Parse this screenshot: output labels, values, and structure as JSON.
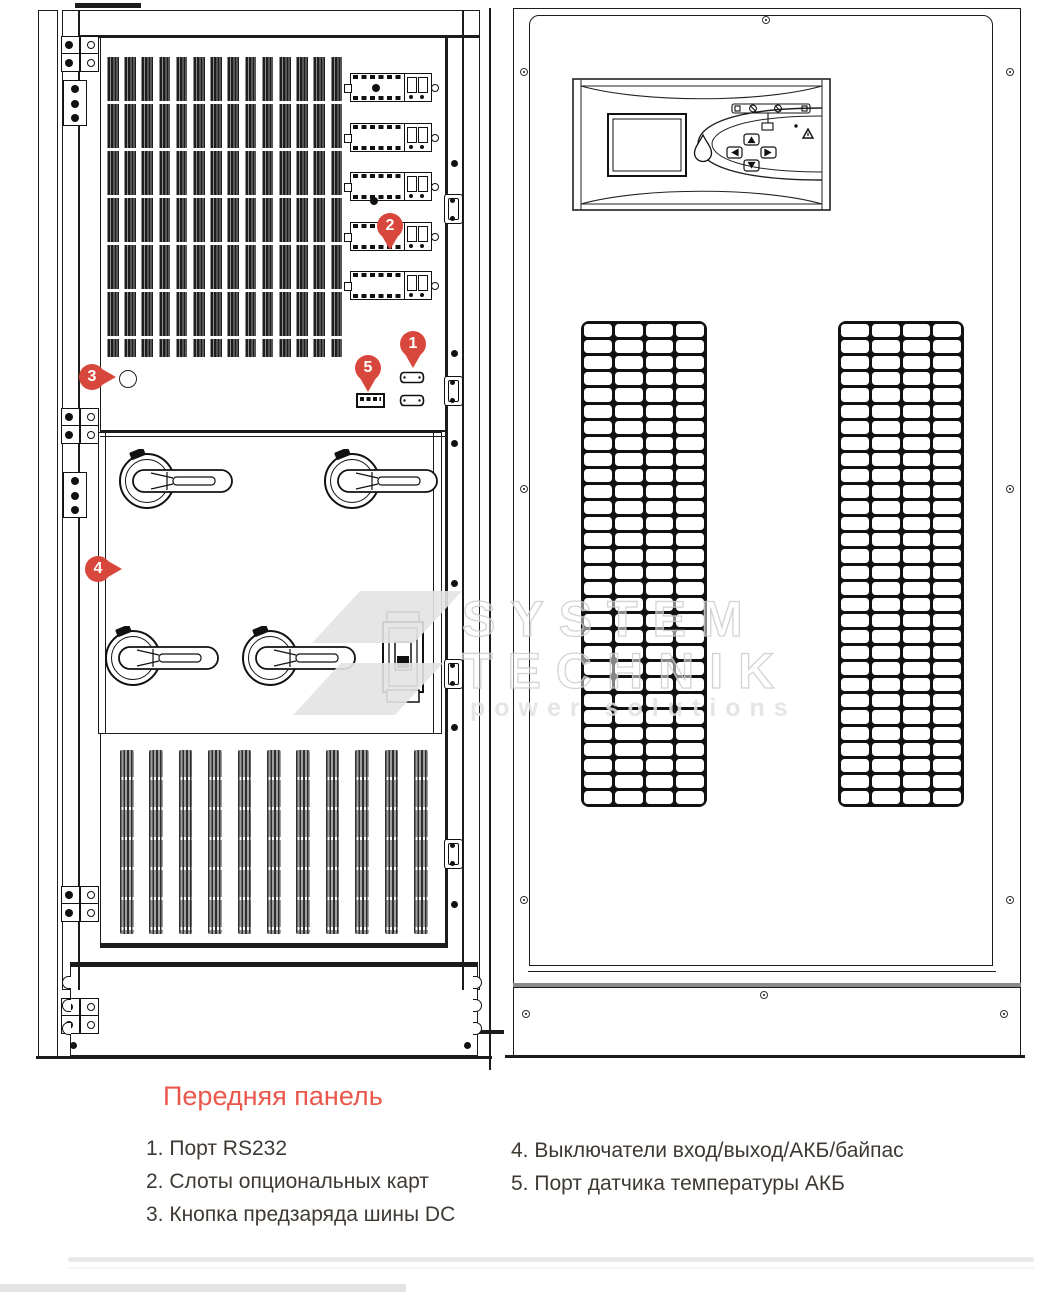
{
  "figure": {
    "title": "Передняя панель",
    "title_color": "#ea574c",
    "marker_color": "#d8473c",
    "markers": [
      {
        "num": "1"
      },
      {
        "num": "2"
      },
      {
        "num": "3"
      },
      {
        "num": "4"
      },
      {
        "num": "5"
      }
    ],
    "legend": {
      "col1": [
        {
          "num": "1.",
          "text": "Порт RS232"
        },
        {
          "num": "2.",
          "text": "Слоты опциональных карт"
        },
        {
          "num": "3.",
          "text": "Кнопка предзаряда шины DC"
        }
      ],
      "col2": [
        {
          "num": "4.",
          "text": "Выключатели вход/выход/АКБ/байпас"
        },
        {
          "num": "5.",
          "text": "Порт датчика температуры АКБ"
        }
      ]
    },
    "watermark": {
      "line1": "SYSTEM",
      "line2": "TECHNIK",
      "line3": "power solutions"
    }
  }
}
